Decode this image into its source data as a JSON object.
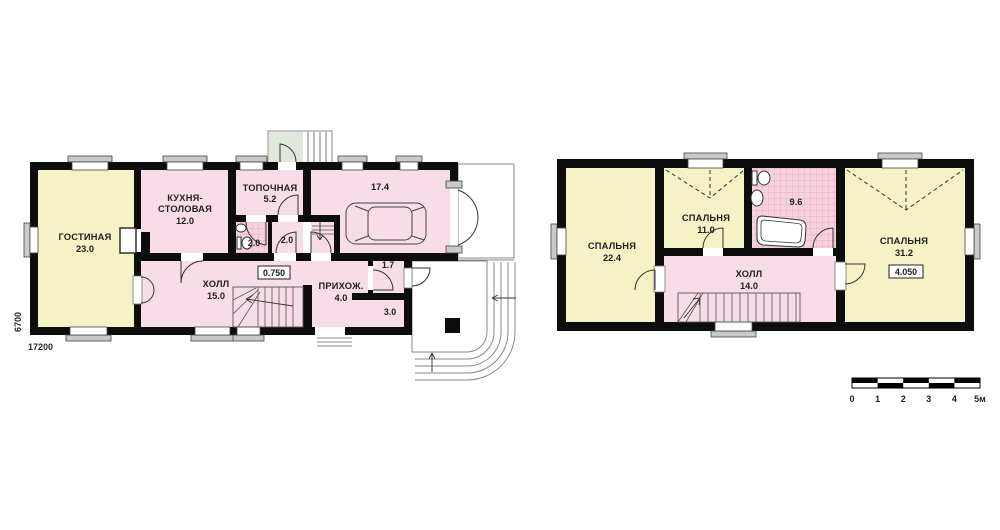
{
  "first_floor": {
    "rooms": {
      "living": {
        "name": "ГОСТИНАЯ",
        "area": "23.0"
      },
      "kitchen": {
        "name1": "КУХНЯ-",
        "name2": "СТОЛОВАЯ",
        "area": "12.0"
      },
      "boiler": {
        "name": "ТОПОЧНАЯ",
        "area": "5.2"
      },
      "bathroom": {
        "area": "2.0"
      },
      "closet": {
        "area": "2.0"
      },
      "garage": {
        "area": "17.4"
      },
      "hall": {
        "name": "ХОЛЛ",
        "area": "15.0"
      },
      "entry": {
        "name": "ПРИХОЖ.",
        "area": "4.0"
      },
      "pantry": {
        "area": "1.7"
      },
      "tambour": {
        "area": "3.0"
      }
    },
    "elevation_mark": "0.750",
    "dim_width": "17200",
    "dim_height": "6700"
  },
  "second_floor": {
    "rooms": {
      "bedroom_left": {
        "name": "СПАЛЬНЯ",
        "area": "22.4"
      },
      "bedroom_middle": {
        "name": "СПАЛЬНЯ",
        "area": "11.0"
      },
      "bathroom": {
        "area": "9.6"
      },
      "hall": {
        "name": "ХОЛЛ",
        "area": "14.0"
      },
      "bedroom_right": {
        "name": "СПАЛЬНЯ",
        "area": "31.2"
      }
    },
    "elevation_mark": "4.050"
  },
  "scale_bar": {
    "ticks": [
      "0",
      "1",
      "2",
      "3",
      "4",
      "5м"
    ]
  },
  "colors": {
    "room_yellow": "#f5f2c6",
    "room_pink": "#f8dde8",
    "bath_tile_pink": "#f7d2dd",
    "terrace_green": "#dfe8da",
    "wall_black": "#0d0d0d",
    "window_gray": "#c9c9c9"
  }
}
